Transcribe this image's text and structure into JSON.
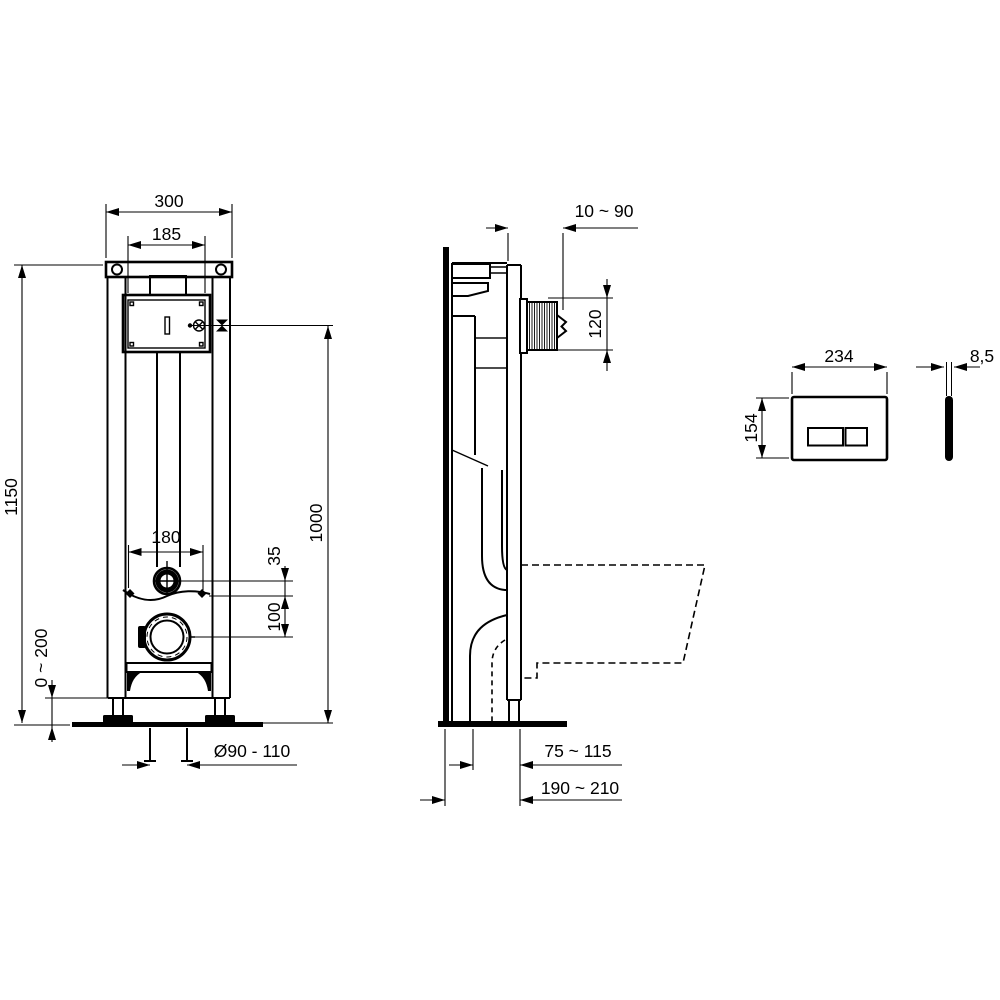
{
  "drawing": {
    "type": "technical-installation-drawing",
    "colors": {
      "line": "#000000",
      "background": "#ffffff"
    },
    "front_view": {
      "frame_width": "300",
      "cistern_width": "185",
      "frame_height": "1150",
      "bolt_spacing": "180",
      "flush_pipe_offset": "35",
      "outlet_offset": "100",
      "reference_height": "1000",
      "foot_adjustment": "0 ~ 200",
      "outlet_diameter": "Ø90 - 110"
    },
    "side_view": {
      "wall_clearance": "10 ~ 90",
      "spigot_height": "120",
      "outlet_distance": "75 ~ 115",
      "frame_depth": "190 ~ 210"
    },
    "flush_plate": {
      "width": "234",
      "height": "154",
      "thickness": "8,5"
    }
  }
}
